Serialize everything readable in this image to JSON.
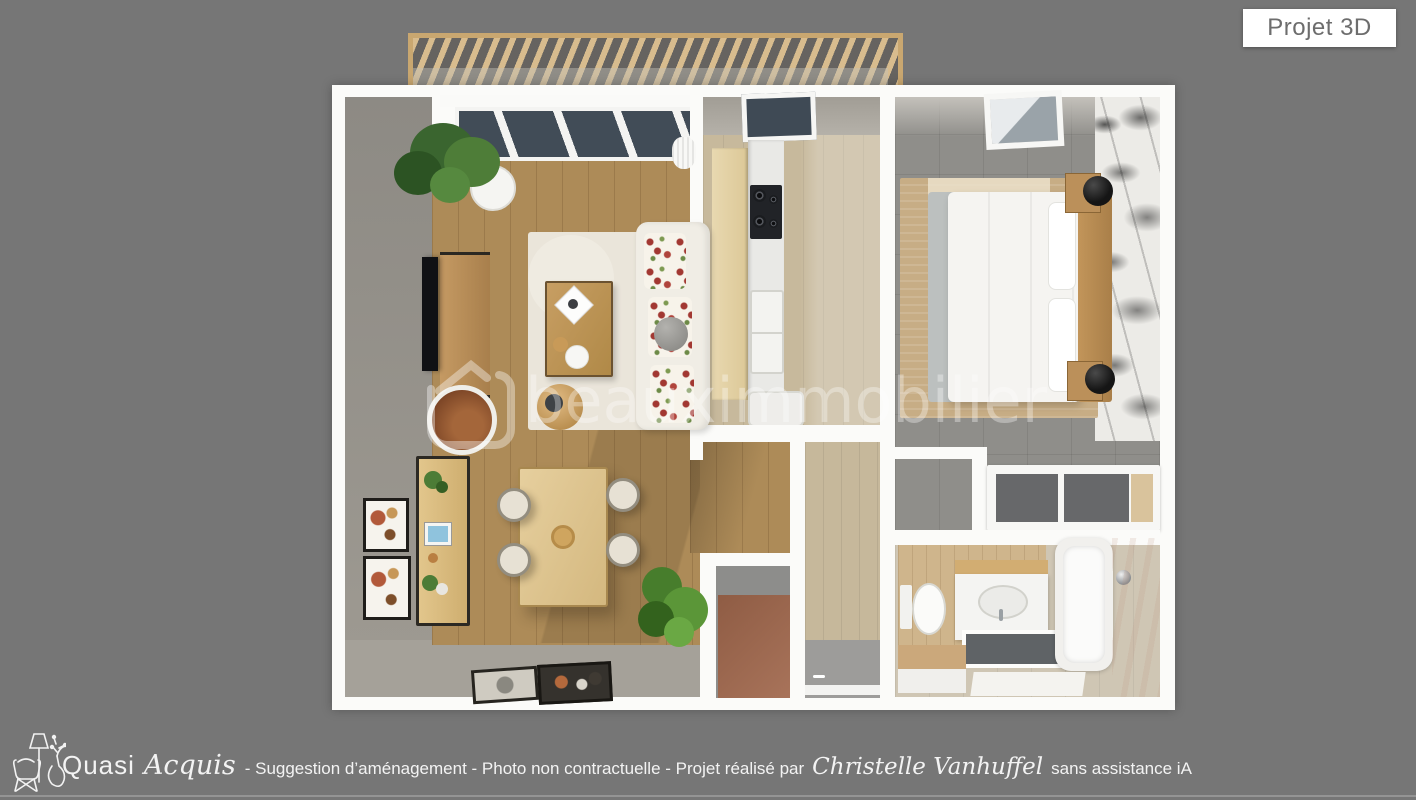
{
  "page": {
    "type": "3d-floor-plan-presentation"
  },
  "badge": {
    "label": "Projet 3D"
  },
  "watermark": {
    "text": "beauximmobilier",
    "icon": "house-outline-icon"
  },
  "footer": {
    "logo_icon": "armchair-floor-lamp-vase-line-art",
    "brand_regular": "Quasi",
    "brand_script": "Acquis",
    "caption_mid": "- Suggestion d’aménagement - Photo non contractuelle - Projet réalisé par",
    "author": "Christelle Vanhuffel",
    "caption_end": "sans assistance iA"
  },
  "floor_plan": {
    "view": "top-down 3d render",
    "rooms": [
      "pergola-terrace",
      "living-dining-room",
      "kitchen",
      "bedroom",
      "dressing",
      "bathroom",
      "hallway",
      "entry"
    ]
  },
  "colors": {
    "background": "#767676",
    "badge_bg": "#ffffff",
    "badge_text": "#6d6d6d",
    "wall_white": "#fbfbf9",
    "wood_living": "#ad8b58",
    "wood_light": "#c7b99c",
    "tile_gray": "#8f8e8a",
    "travertine": "#cfc6b4",
    "terracotta": "#9f6b53",
    "rug_cream": "#eae5da",
    "rug_tan": "#c7ad85",
    "pergola_wood": "#d8bc8e",
    "greige_wall": "#8d8a84",
    "footer_text": "#f3f3f3"
  }
}
